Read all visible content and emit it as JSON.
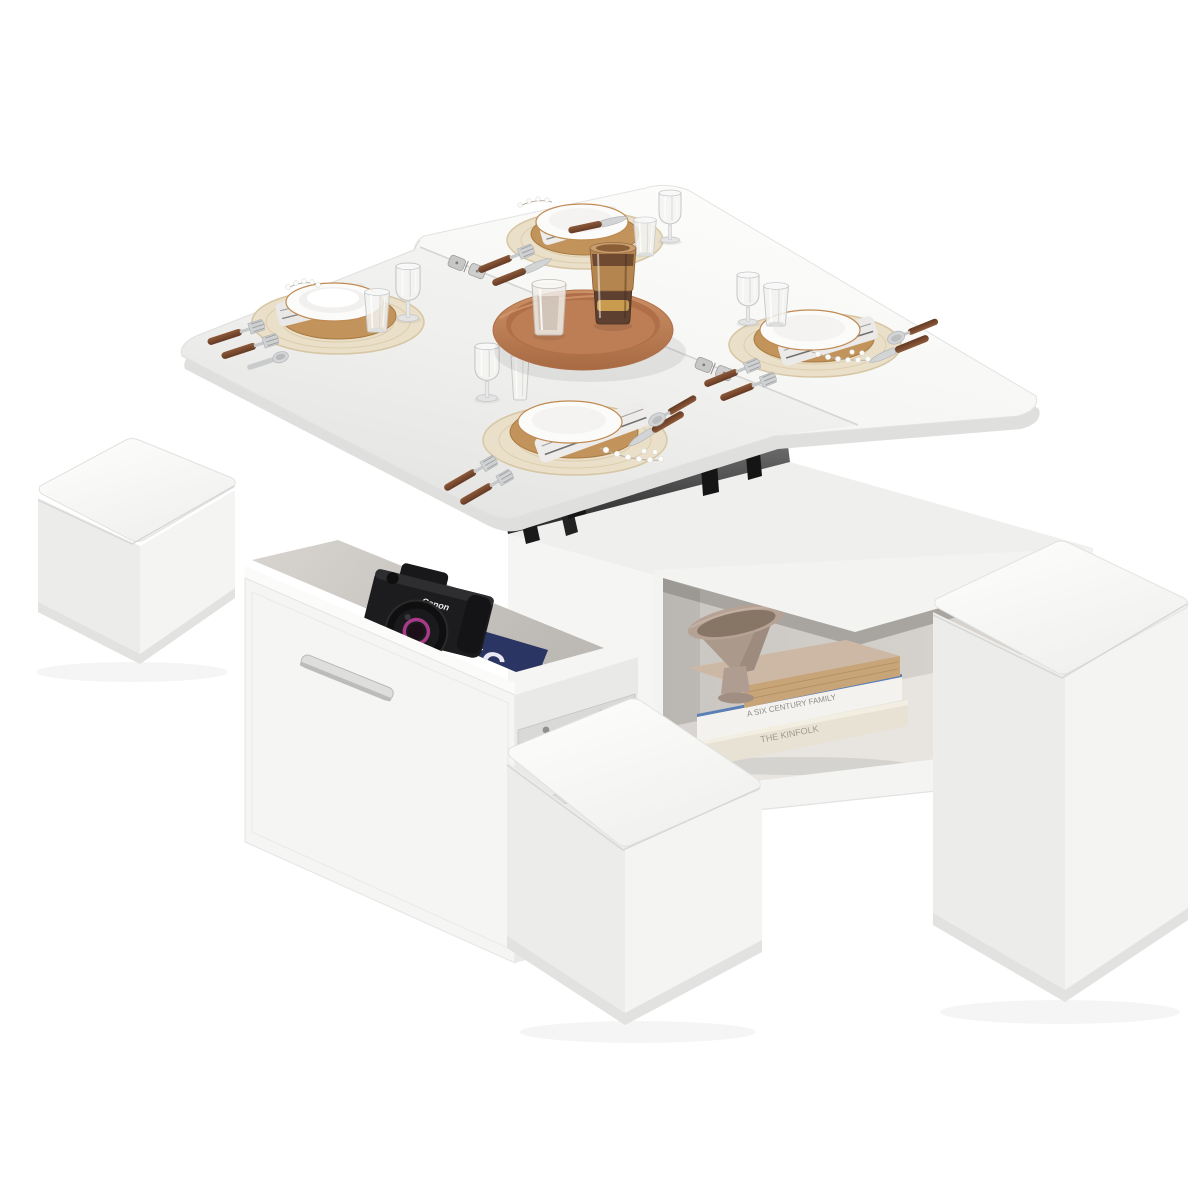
{
  "scene": {
    "description": "Product photo: white lift-top extendable square table with storage base (open drawer and open side shelf) styled with four place settings, centre tray, and white cube storage stools",
    "texts": {
      "book_spine_top": "A SIX CENTURY FAMILY",
      "book_spine_bottom": "THE KINFOLK",
      "camera_brand": "Canon",
      "magazine_letters": "YC"
    },
    "counts": {
      "place_settings": 4,
      "stools_visible": 3,
      "seam_hinges": 2,
      "books_on_shelf": 3,
      "glasses_on_table": 8,
      "items_on_tray": 2
    },
    "colors": {
      "background": "#ffffff",
      "table_white": "#f7f7f6",
      "table_shadowed": "#e9e9e7",
      "tray_terracotta": "#bd7e55",
      "tray_inner": "#b06f48",
      "placemat_beige": "#eadfc9",
      "charger_wood": "#c2945c",
      "plate_white": "#fbfbfa",
      "plate_rim": "#c08a52",
      "cutlery_handle_walnut": "#7a4a30",
      "cutlery_silver": "#cfd1d2",
      "amber_glass": "#a5713f",
      "amber_glass_dark": "#5d4030",
      "gold_band": "#c99b4f",
      "napkin_grey": "#e9e8e6",
      "navy_book": "#2b3563",
      "camera_black": "#1c1c1e",
      "lens_accent_magenta": "#a83a88",
      "bowl_taupe": "#b3a093",
      "book_taupe": "#cdb8a6",
      "book_white": "#f4f2ee",
      "book_cream": "#e8e2d4",
      "mechanism_black": "#161616",
      "stool_white": "#f4f4f3"
    }
  }
}
